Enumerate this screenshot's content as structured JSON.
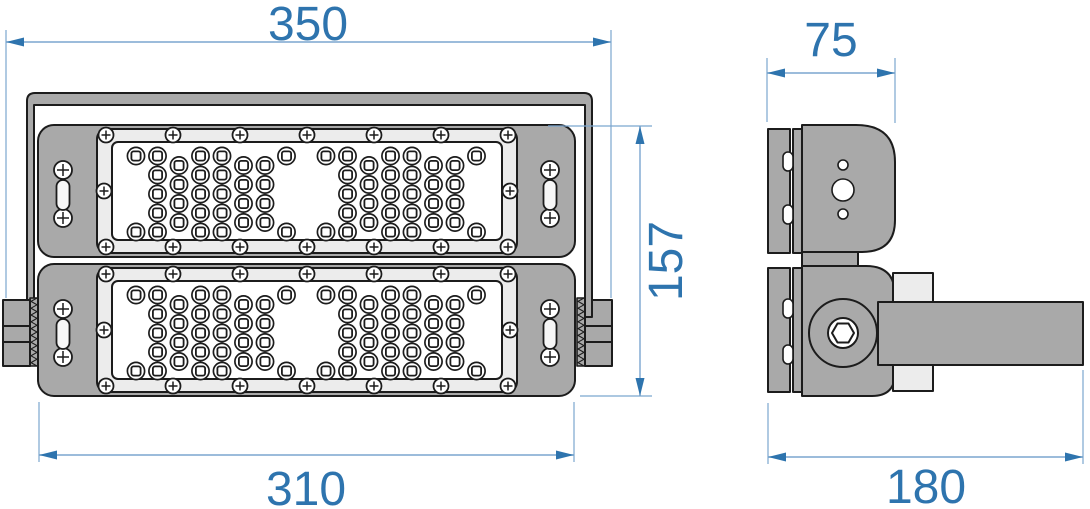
{
  "drawing": {
    "kind": "technical-dimension-drawing",
    "subject": "LED flood light with mounting bracket, two lens modules",
    "views": {
      "front": {
        "modules": 2,
        "lens_rows": 5,
        "lens_groups_per_module": 2
      },
      "side": {
        "holes_in_side_plate": 3,
        "pivot_bolt": "hex-socket"
      }
    },
    "dimensions": {
      "overall_width": {
        "value": "350"
      },
      "body_width": {
        "value": "310"
      },
      "body_height": {
        "value": "157"
      },
      "body_depth": {
        "value": "75"
      },
      "overall_depth": {
        "value": "180"
      }
    },
    "colors": {
      "outline": "#1c1c1c",
      "body_gray": "#a9a9a9",
      "frame_gray": "#ececec",
      "panel_white": "#ffffff",
      "dimension_line": "#7ba6cf",
      "dimension_text": "#2e74ae",
      "dimension_arrow": "#2e74ae"
    }
  }
}
